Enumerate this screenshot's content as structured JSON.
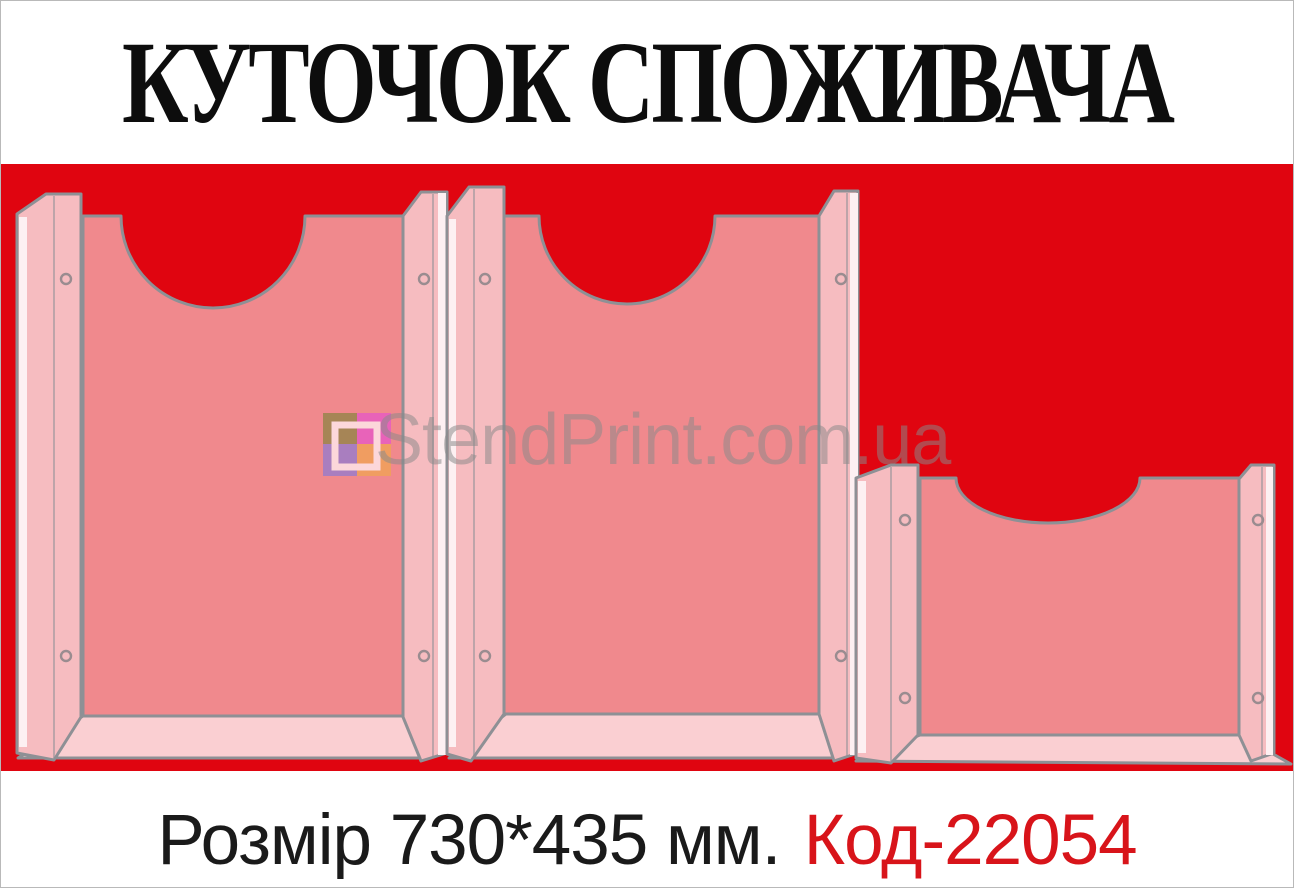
{
  "title": "КУТОЧОК СПОЖИВАЧА",
  "watermark": {
    "text": "StendPrint.com.ua"
  },
  "caption": {
    "size_label": "Розмір 730*435 мм.",
    "code_label": "Код-22054"
  },
  "board": {
    "pocket_count": 3,
    "pockets": [
      "a4-portrait-left",
      "a4-portrait-center",
      "a5-landscape-right"
    ]
  },
  "icons": {
    "logo": "stendprint-logo-icon"
  },
  "colors": {
    "board_red": "#e00510",
    "panel_pink": "#f0898d",
    "rail_pink": "#f6bcc0",
    "rail_highlight": "#fdf0f2",
    "shelf_pink": "#facfd2",
    "outline_gray": "#8e9095",
    "hole_gray": "#9a8c90",
    "title_black": "#0d0d0d",
    "caption_black": "#1a1a1a",
    "code_red": "#d8141a",
    "watermark_gray": "#8a8a8a",
    "logo_olive": "#97854b",
    "logo_magenta": "#e75bc3",
    "logo_purple": "#9a7ccb",
    "logo_orange": "#f0a258"
  }
}
